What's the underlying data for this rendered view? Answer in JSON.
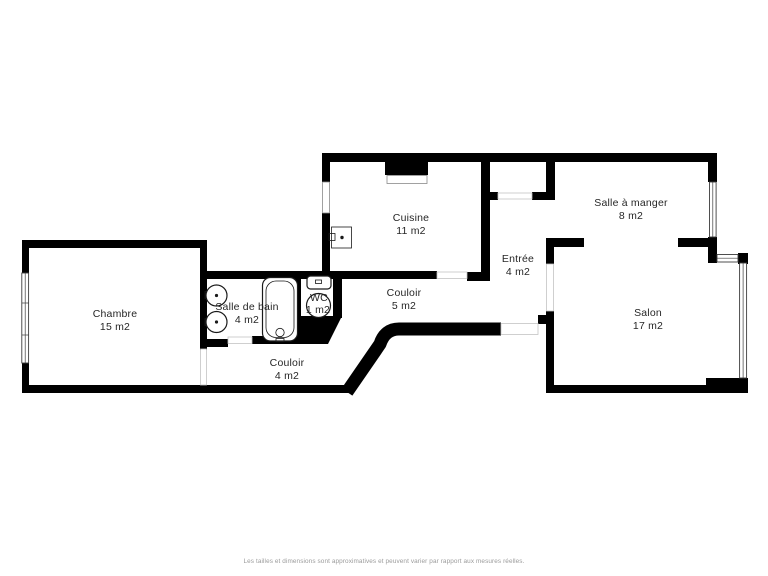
{
  "floor_plan": {
    "rooms": [
      {
        "name": "Chambre",
        "area": "15 m2"
      },
      {
        "name": "Salle de bain",
        "area": "4 m2"
      },
      {
        "name": "WC",
        "area": "1 m2"
      },
      {
        "name": "Couloir",
        "area": "4 m2"
      },
      {
        "name": "Cuisine",
        "area": "11 m2"
      },
      {
        "name": "Couloir",
        "area": "5 m2"
      },
      {
        "name": "Entrée",
        "area": "4 m2"
      },
      {
        "name": "Salle à manger",
        "area": "8 m2"
      },
      {
        "name": "Salon",
        "area": "17 m2"
      }
    ],
    "colors": {
      "wall": "#000000",
      "text": "#262626",
      "background": "#ffffff",
      "disclaimer_text": "#9b9b9b"
    },
    "footer": {
      "disclaimer": "Les tailles et dimensions sont approximatives et peuvent varier par rapport aux mesures réelles."
    }
  }
}
